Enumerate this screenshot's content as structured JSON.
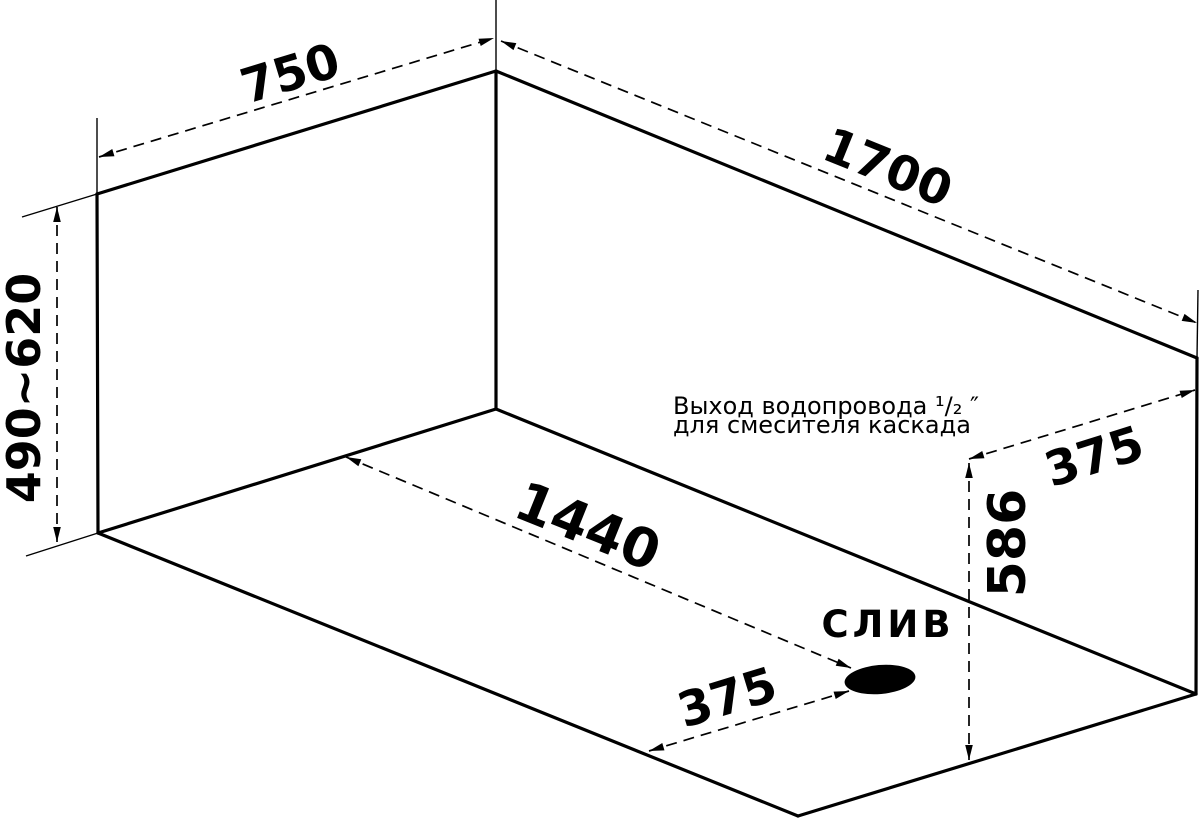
{
  "diagram": {
    "background": "#ffffff",
    "line_color": "#000000",
    "dimensions": {
      "top_width": "750",
      "top_length": "1700",
      "left_height_range": "490~620",
      "drain_diagonal": "1440",
      "drain_edge_offset": "375",
      "outlet_wall_offset": "375",
      "outlet_height": "586"
    },
    "labels": {
      "drain": "СЛИВ",
      "outlet_note_line1": "Выход водопровода ¹/₂ ″",
      "outlet_note_line2": "для смесителя каскада"
    }
  }
}
